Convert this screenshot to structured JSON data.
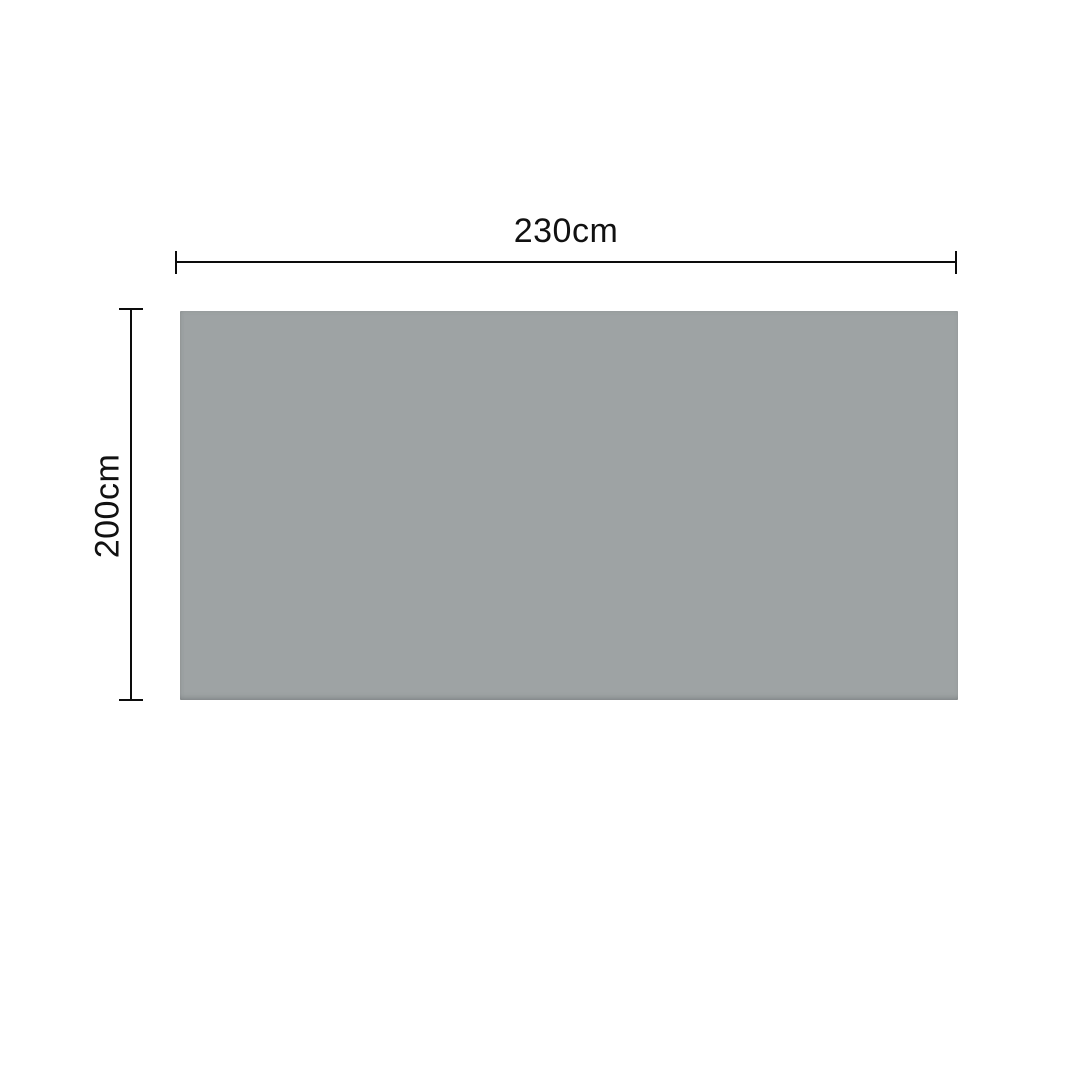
{
  "diagram": {
    "type": "product-dimension-diagram",
    "shape": "rectangle",
    "width_dimension": {
      "label": "230cm",
      "position": "top"
    },
    "height_dimension": {
      "label": "200cm",
      "position": "left"
    },
    "colors": {
      "background": "#ffffff",
      "rect_fill": "#9ea3a4",
      "dimension_line": "#0c0c0c",
      "label_text": "#111111"
    }
  }
}
